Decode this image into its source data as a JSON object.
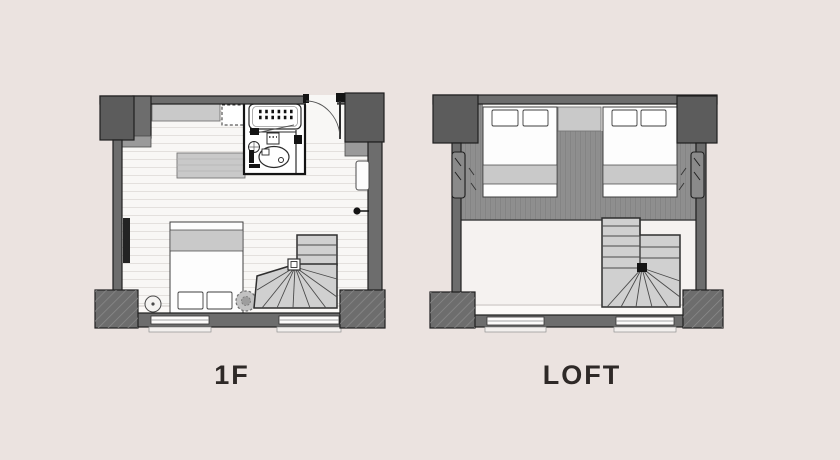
{
  "image": {
    "kind": "floor-plan-illustration",
    "plans": [
      {
        "id": "1f",
        "label": "1F"
      },
      {
        "id": "loft",
        "label": "LOFT"
      }
    ]
  },
  "palette": {
    "background": "#ebe3e0",
    "wall": "#6d6d6d",
    "wall_dark": "#5c5c5c",
    "outline": "#1f1f1f",
    "floor": "#f8f7f5",
    "plank_line": "#e3e0dd",
    "deck": "#8f8f8f",
    "furniture": "#c9c9c9",
    "bed": "#fdfdfd",
    "stair": "#d0d0d0",
    "stair_line": "#2f2f2f",
    "step": "#9a9a9a",
    "void": "#f5f2f0",
    "label_color": "#2e2927"
  }
}
